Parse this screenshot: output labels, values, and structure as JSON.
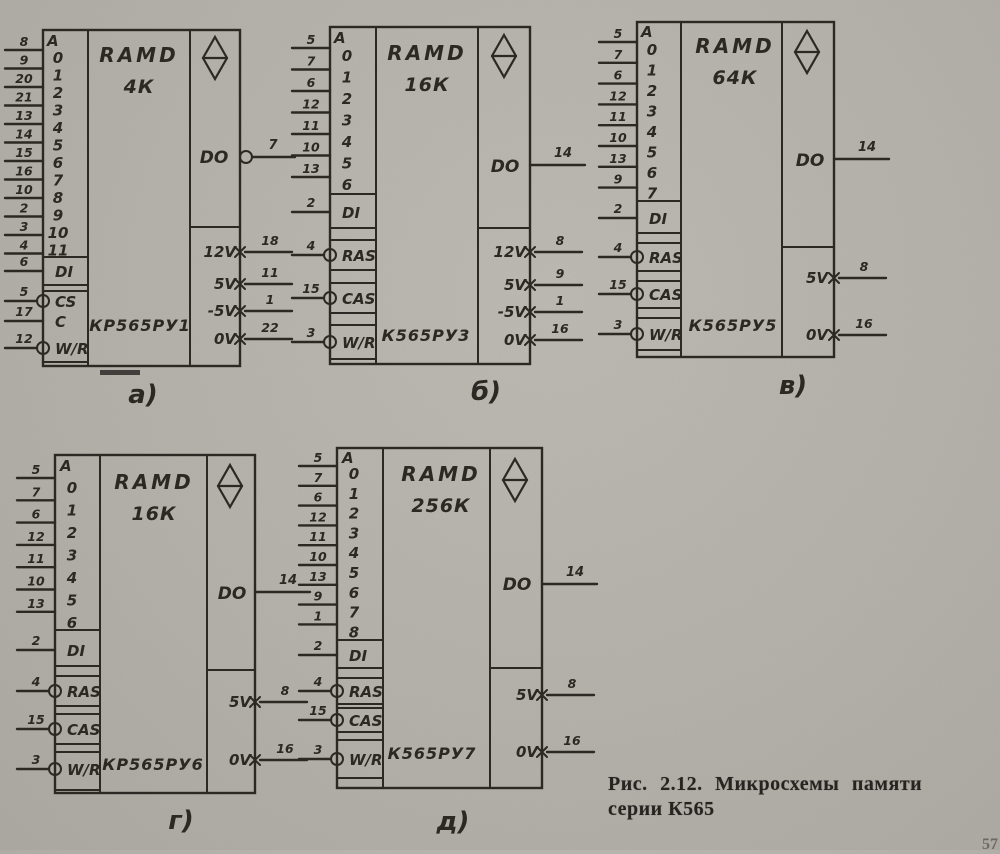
{
  "figure": {
    "caption_line1": "Рис. 2.12. Микросхемы памяти",
    "caption_line2": "серии К565",
    "page_number": "57"
  },
  "colors": {
    "ink": "#2c2823",
    "paper": "#b4b1aa"
  },
  "chips": [
    {
      "label": "а)",
      "title": "RAMD",
      "capacity": "4К",
      "part": "КР565РУ1",
      "addr_header": "A",
      "addr_bits": [
        "0",
        "1",
        "2",
        "3",
        "4",
        "5",
        "6",
        "7",
        "8",
        "9",
        "10",
        "11"
      ],
      "addr_pins": [
        "8",
        "9",
        "20",
        "21",
        "13",
        "14",
        "15",
        "16",
        "10",
        "2",
        "3",
        "4"
      ],
      "inputs": [
        {
          "label": "DI",
          "pin": "6",
          "inverted": false
        },
        {
          "label": "CS",
          "pin": "5",
          "inverted": true
        },
        {
          "label": "C",
          "pin": "17",
          "inverted": false
        },
        {
          "label": "W/R",
          "pin": "12",
          "inverted": true
        }
      ],
      "output": {
        "label": "DO",
        "pin": "7",
        "inverted": true
      },
      "power": [
        {
          "label": "12V",
          "pin": "18"
        },
        {
          "label": "5V",
          "pin": "11"
        },
        {
          "label": "-5V",
          "pin": "1"
        },
        {
          "label": "0V",
          "pin": "22"
        }
      ]
    },
    {
      "label": "б)",
      "title": "RAMD",
      "capacity": "16К",
      "part": "К565РУ3",
      "addr_header": "A",
      "addr_bits": [
        "0",
        "1",
        "2",
        "3",
        "4",
        "5",
        "6"
      ],
      "addr_pins": [
        "5",
        "7",
        "6",
        "12",
        "11",
        "10",
        "13"
      ],
      "inputs": [
        {
          "label": "DI",
          "pin": "2",
          "inverted": false
        },
        {
          "label": "RAS",
          "pin": "4",
          "inverted": true
        },
        {
          "label": "CAS",
          "pin": "15",
          "inverted": true
        },
        {
          "label": "W/R",
          "pin": "3",
          "inverted": true
        }
      ],
      "output": {
        "label": "DO",
        "pin": "14",
        "inverted": false
      },
      "power": [
        {
          "label": "12V",
          "pin": "8"
        },
        {
          "label": "5V",
          "pin": "9"
        },
        {
          "label": "-5V",
          "pin": "1"
        },
        {
          "label": "0V",
          "pin": "16"
        }
      ]
    },
    {
      "label": "в)",
      "title": "RAMD",
      "capacity": "64К",
      "part": "К565РУ5",
      "addr_header": "A",
      "addr_bits": [
        "0",
        "1",
        "2",
        "3",
        "4",
        "5",
        "6",
        "7"
      ],
      "addr_pins": [
        "5",
        "7",
        "6",
        "12",
        "11",
        "10",
        "13",
        "9"
      ],
      "inputs": [
        {
          "label": "DI",
          "pin": "2",
          "inverted": false
        },
        {
          "label": "RAS",
          "pin": "4",
          "inverted": true
        },
        {
          "label": "CAS",
          "pin": "15",
          "inverted": true
        },
        {
          "label": "W/R",
          "pin": "3",
          "inverted": true
        }
      ],
      "output": {
        "label": "DO",
        "pin": "14",
        "inverted": false
      },
      "power": [
        {
          "label": "5V",
          "pin": "8"
        },
        {
          "label": "0V",
          "pin": "16"
        }
      ]
    },
    {
      "label": "г)",
      "title": "RAMD",
      "capacity": "16К",
      "part": "КР565РУ6",
      "addr_header": "A",
      "addr_bits": [
        "0",
        "1",
        "2",
        "3",
        "4",
        "5",
        "6"
      ],
      "addr_pins": [
        "5",
        "7",
        "6",
        "12",
        "11",
        "10",
        "13"
      ],
      "inputs": [
        {
          "label": "DI",
          "pin": "2",
          "inverted": false
        },
        {
          "label": "RAS",
          "pin": "4",
          "inverted": true
        },
        {
          "label": "CAS",
          "pin": "15",
          "inverted": true
        },
        {
          "label": "W/R",
          "pin": "3",
          "inverted": true
        }
      ],
      "output": {
        "label": "DO",
        "pin": "14",
        "inverted": false
      },
      "power": [
        {
          "label": "5V",
          "pin": "8"
        },
        {
          "label": "0V",
          "pin": "16"
        }
      ]
    },
    {
      "label": "д)",
      "title": "RAMD",
      "capacity": "256К",
      "part": "К565РУ7",
      "addr_header": "A",
      "addr_bits": [
        "0",
        "1",
        "2",
        "3",
        "4",
        "5",
        "6",
        "7",
        "8"
      ],
      "addr_pins": [
        "5",
        "7",
        "6",
        "12",
        "11",
        "10",
        "13",
        "9",
        "1"
      ],
      "inputs": [
        {
          "label": "DI",
          "pin": "2",
          "inverted": false
        },
        {
          "label": "RAS",
          "pin": "4",
          "inverted": true
        },
        {
          "label": "CAS",
          "pin": "15",
          "inverted": true
        },
        {
          "label": "W/R",
          "pin": "3",
          "inverted": true
        }
      ],
      "output": {
        "label": "DO",
        "pin": "14",
        "inverted": false
      },
      "power": [
        {
          "label": "5V",
          "pin": "8"
        },
        {
          "label": "0V",
          "pin": "16"
        }
      ]
    }
  ]
}
